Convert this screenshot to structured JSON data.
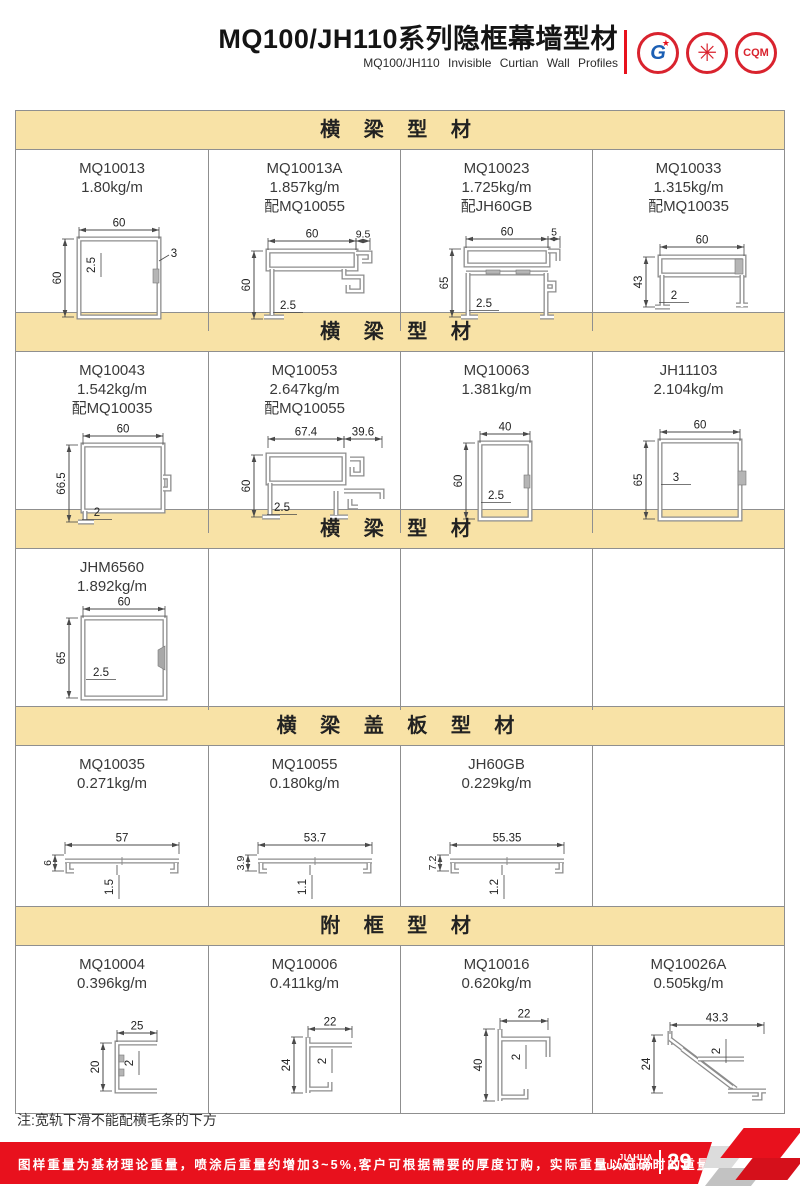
{
  "header": {
    "title": "MQ100/JH110系列隐框幕墙型材",
    "subtitle": "MQ100/JH110  Invisible  Curtian  Wall  Profiles",
    "logos": [
      {
        "name": "gb-certification-mark",
        "glyph": "G",
        "star": "★"
      },
      {
        "name": "certification-seal",
        "glyph": "✳"
      },
      {
        "name": "cqm-certification-mark",
        "glyph": "CQM"
      }
    ]
  },
  "colors": {
    "band_bg": "#f8e2a6",
    "accent_red": "#e8111d",
    "table_border": "#8f8f8f"
  },
  "sections": [
    {
      "title": "横 梁 型 材",
      "cells": [
        {
          "code": "MQ10013",
          "weight": "1.80kg/m",
          "match": "",
          "shape": "sq13",
          "dims": {
            "top": "60",
            "left": "60",
            "wall": "2.5",
            "extra": "3"
          }
        },
        {
          "code": "MQ10013A",
          "weight": "1.857kg/m",
          "match": "配MQ10055",
          "shape": "p13a",
          "dims": {
            "top": "60",
            "top2": "9.5",
            "left": "60",
            "wall": "2.5"
          }
        },
        {
          "code": "MQ10023",
          "weight": "1.725kg/m",
          "match": "配JH60GB",
          "shape": "p23",
          "dims": {
            "top": "60",
            "top2": "5",
            "left": "65",
            "wall": "2.5"
          }
        },
        {
          "code": "MQ10033",
          "weight": "1.315kg/m",
          "match": "配MQ10035",
          "shape": "p33",
          "dims": {
            "top": "60",
            "left": "43",
            "wall": "2"
          }
        }
      ]
    },
    {
      "title": "横 梁 型 材",
      "cells": [
        {
          "code": "MQ10043",
          "weight": "1.542kg/m",
          "match": "配MQ10035",
          "shape": "p43",
          "dims": {
            "top": "60",
            "left": "66.5",
            "wall": "2"
          }
        },
        {
          "code": "MQ10053",
          "weight": "2.647kg/m",
          "match": "配MQ10055",
          "shape": "p53",
          "dims": {
            "top": "67.4",
            "top2": "39.6",
            "left": "60",
            "wall": "2.5"
          }
        },
        {
          "code": "MQ10063",
          "weight": "1.381kg/m",
          "match": "",
          "shape": "p63",
          "dims": {
            "top": "40",
            "left": "60",
            "wall": "2.5"
          }
        },
        {
          "code": "JH11103",
          "weight": "2.104kg/m",
          "match": "",
          "shape": "p11103",
          "dims": {
            "top": "60",
            "left": "65",
            "wall": "3"
          }
        }
      ]
    },
    {
      "title": "横 梁 型 材",
      "cells": [
        {
          "code": "JHM6560",
          "weight": "1.892kg/m",
          "match": "",
          "shape": "p6560",
          "dims": {
            "top": "60",
            "left": "65",
            "wall": "2.5"
          }
        },
        null,
        null,
        null
      ]
    },
    {
      "title": "横 梁 盖 板 型 材",
      "cells": [
        {
          "code": "MQ10035",
          "weight": "0.271kg/m",
          "match": "",
          "shape": "cap",
          "dims": {
            "top": "57",
            "left": "6",
            "wall": "1.5"
          }
        },
        {
          "code": "MQ10055",
          "weight": "0.180kg/m",
          "match": "",
          "shape": "cap",
          "dims": {
            "top": "53.7",
            "left": "3.9",
            "wall": "1.1"
          }
        },
        {
          "code": "JH60GB",
          "weight": "0.229kg/m",
          "match": "",
          "shape": "cap",
          "dims": {
            "top": "55.35",
            "left": "7.2",
            "wall": "1.2"
          }
        },
        null
      ]
    },
    {
      "title": "附 框 型 材",
      "cells": [
        {
          "code": "MQ10004",
          "weight": "0.396kg/m",
          "match": "",
          "shape": "p04",
          "dims": {
            "top": "25",
            "left": "20",
            "wall": "2"
          }
        },
        {
          "code": "MQ10006",
          "weight": "0.411kg/m",
          "match": "",
          "shape": "p06",
          "dims": {
            "top": "22",
            "left": "24",
            "wall": "2"
          }
        },
        {
          "code": "MQ10016",
          "weight": "0.620kg/m",
          "match": "",
          "shape": "p16",
          "dims": {
            "top": "22",
            "left": "40",
            "wall": "2"
          }
        },
        {
          "code": "MQ10026A",
          "weight": "0.505kg/m",
          "match": "",
          "shape": "p26a",
          "dims": {
            "top": "43.3",
            "left": "24",
            "wall": "2"
          }
        }
      ]
    }
  ],
  "note": "注:宽轨下滑不能配横毛条的下方",
  "footer": {
    "disclaimer": "图样重量为基材理论重量，喷涂后重量约增加3~5%,客户可根据需要的厚度订购，实际重量以过磅时的重量为准。",
    "brand_line1": "JIAHUA",
    "brand_line2": "ALUMINIUM",
    "page_number": "29"
  }
}
